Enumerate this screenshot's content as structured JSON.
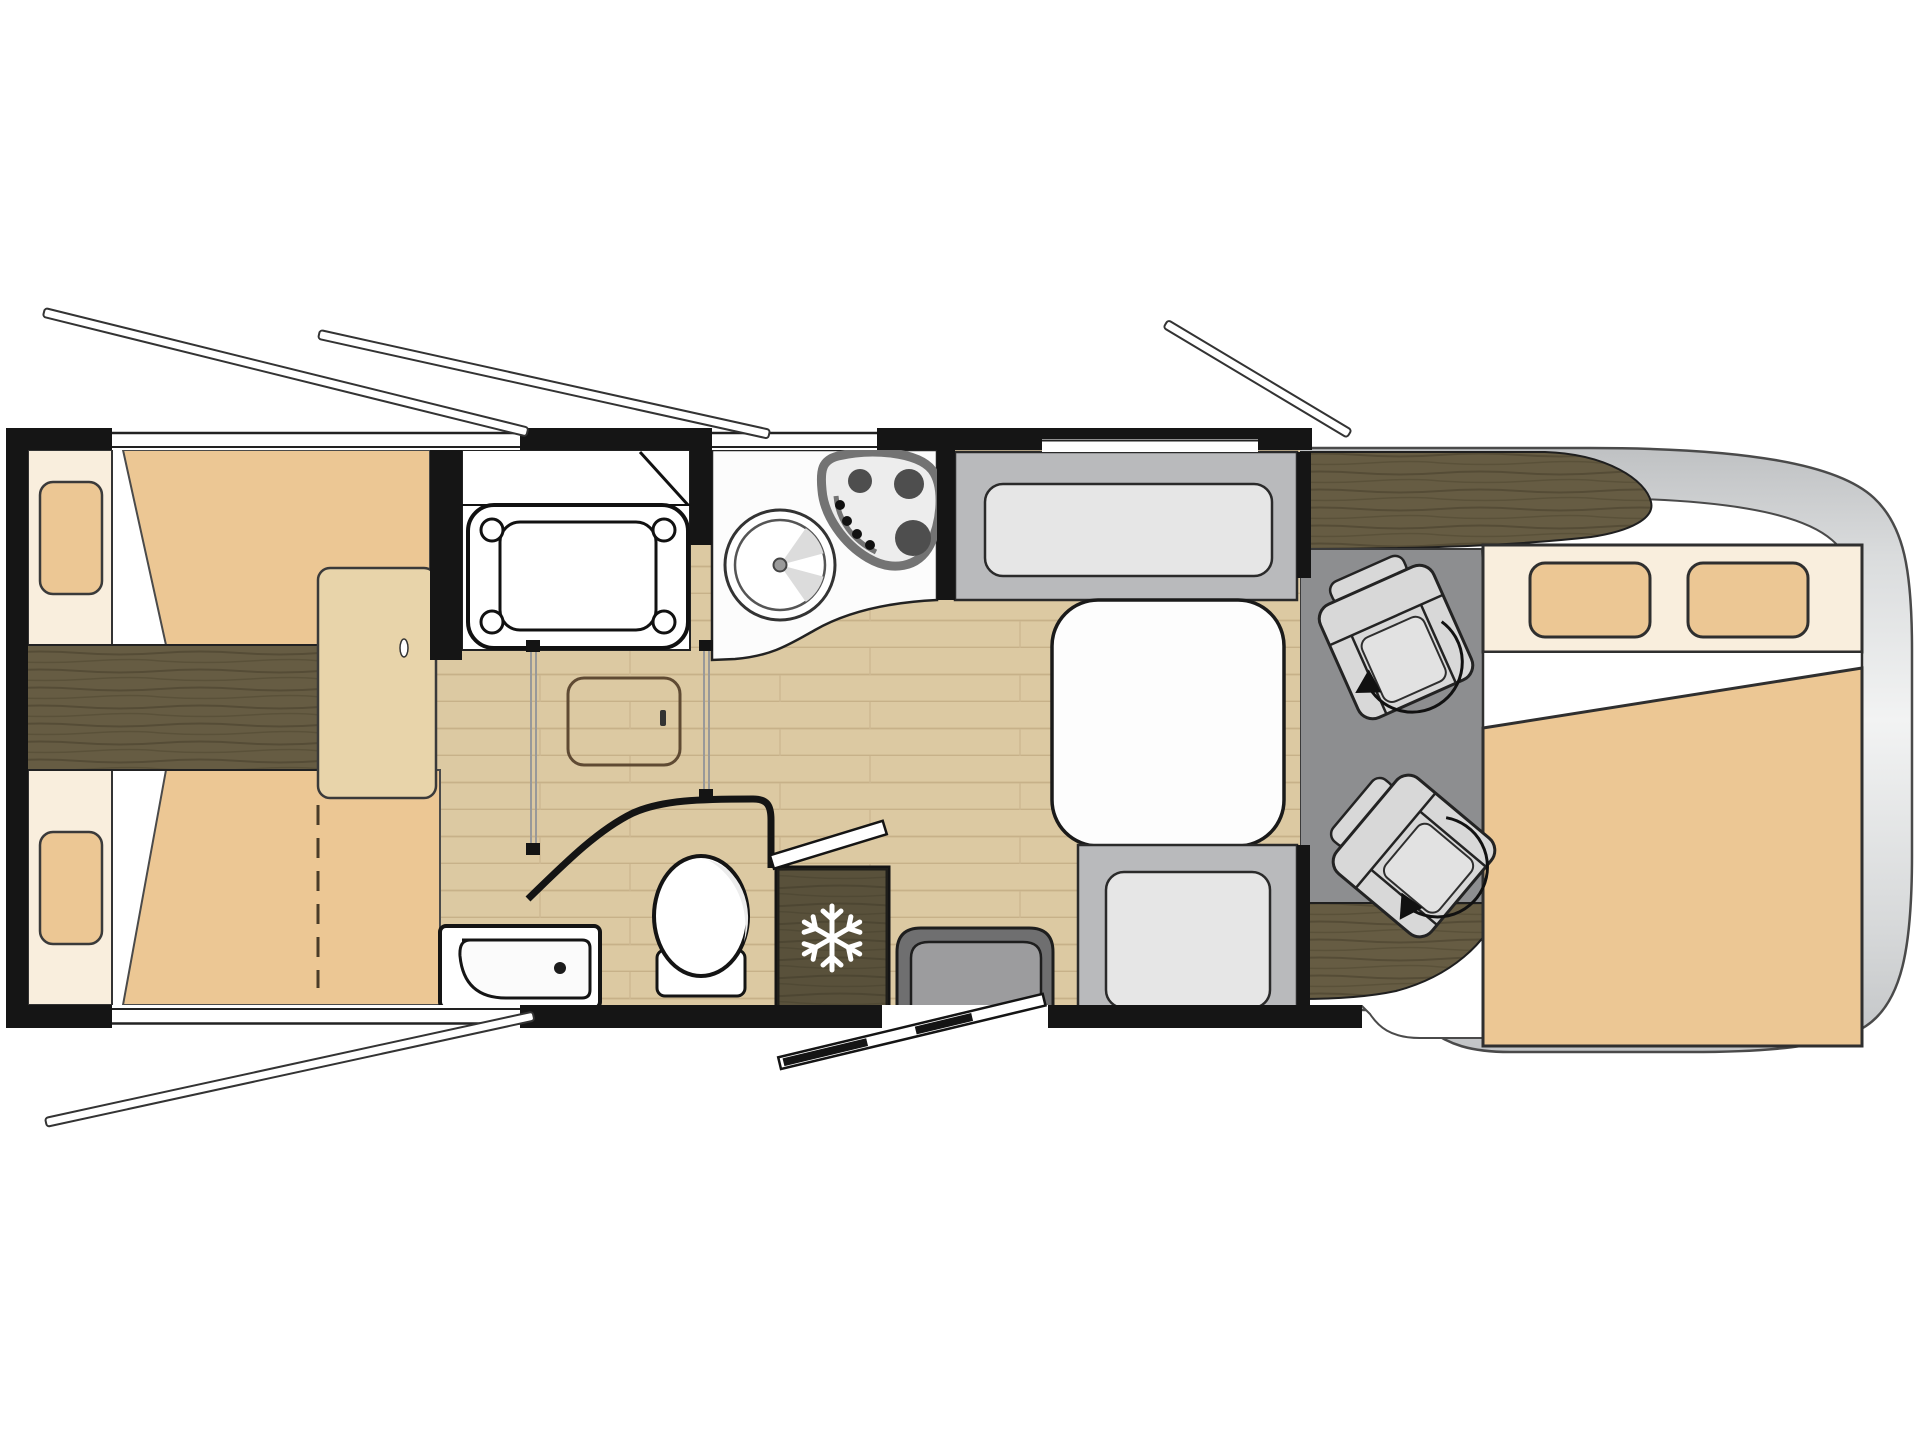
{
  "title": "Motorhome floor plan, top view: rear twin beds, shower, kitchen, bathroom, fridge, dinette with table, swivel cab seats and overcab bed",
  "colors": {
    "wall": "#151515",
    "outline": "#2f2f2f",
    "mattress": "#ecc794",
    "headboard": "#f9eedd",
    "floor": "#dcc9a2",
    "floor_line": "#c7b189",
    "dark_wood": "#665c43",
    "dark_wood_grain": "#554c36",
    "step_wood": "#e8d4aa",
    "bench": "#b9babc",
    "cushion": "#e6e6e6",
    "table": "#fdfdfd",
    "cab_floor": "#8d8e90",
    "cab_body_light": "#f2f3f3",
    "cab_body_dark": "#c0c2c4",
    "seat": "#d8d8d8",
    "step_outer": "#6f6f70",
    "step_inner": "#9c9c9e",
    "hob_rim": "#737373",
    "hob_face": "#ededed",
    "burner": "#4e4e4e",
    "snowflake": "#ffffff",
    "white": "#ffffff"
  },
  "elements": {
    "bedroom": [
      "twin-bed-upper",
      "twin-bed-lower",
      "pillow",
      "center-aisle-dark-wood",
      "bed-step",
      "fold-out-dashed-line"
    ],
    "wet_areas": [
      "shower-cabin",
      "shower-tray",
      "toilet",
      "corner-washbasin",
      "sliding-door-rails",
      "curved-bathroom-wall",
      "floor-hatch"
    ],
    "kitchen": [
      "worktop",
      "round-sink",
      "three-burner-hob"
    ],
    "appliances": [
      "fridge-with-snowflake"
    ],
    "dinette": [
      "bench-front",
      "bench-rear",
      "dinette-table",
      "entry-step-mat"
    ],
    "cab": [
      "dashboard",
      "swivel-seat-left",
      "swivel-seat-right",
      "rotation-arrow",
      "overcab-bed",
      "overcab-pillows",
      "vehicle-body"
    ],
    "openings": [
      "window-open-flaps",
      "entry-door-open",
      "wall-windows"
    ]
  }
}
